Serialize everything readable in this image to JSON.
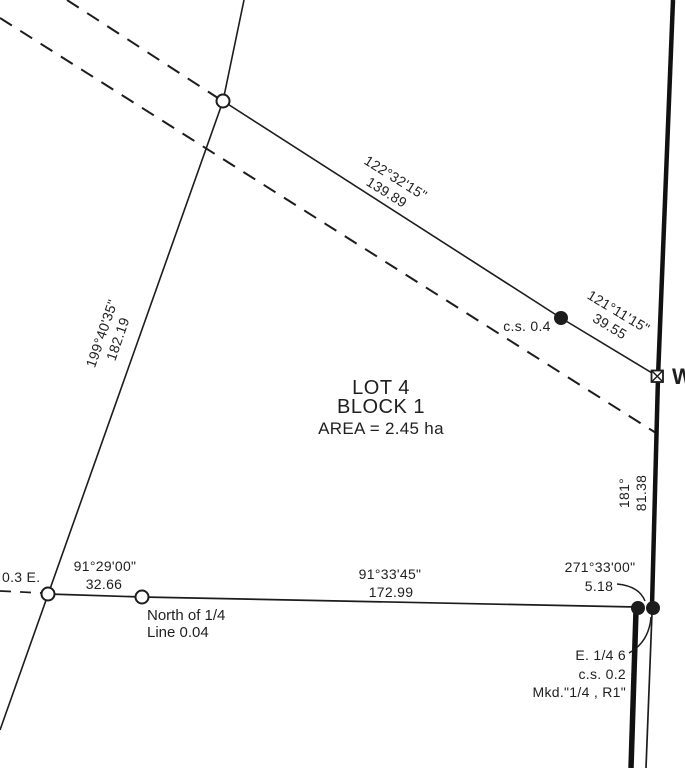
{
  "plat": {
    "lot": {
      "name": "LOT 4",
      "block": "BLOCK 1",
      "area": "AREA = 2.45 ha"
    },
    "bearings": {
      "north_seg1": {
        "bearing": "122°32'15\"",
        "distance": "139.89"
      },
      "north_seg2": {
        "bearing": "121°11'15\"",
        "distance": "39.55"
      },
      "west_line": {
        "bearing": "199°40'35\"",
        "distance": "182.19"
      },
      "east_line": {
        "bearing": "181°",
        "distance": "81.38"
      },
      "south_seg1": {
        "bearing": "91°29'00\"",
        "distance": "32.66"
      },
      "south_seg2": {
        "bearing": "91°33'45\"",
        "distance": "172.99"
      },
      "south_tie": {
        "bearing": "271°33'00\"",
        "distance": "5.18"
      }
    },
    "notes": {
      "cs_north": "c.s. 0.4",
      "offset_east": "0.3 E.",
      "quarter_line_1": "North of 1/4",
      "quarter_line_2": "Line 0.04",
      "corner_line_1": "E. 1/4 6",
      "corner_line_2": "c.s. 0.2",
      "corner_line_3": "Mkd.\"1/4 , R1\"",
      "road_letter": "W"
    },
    "colors": {
      "ink": "#1c1c1c"
    }
  }
}
